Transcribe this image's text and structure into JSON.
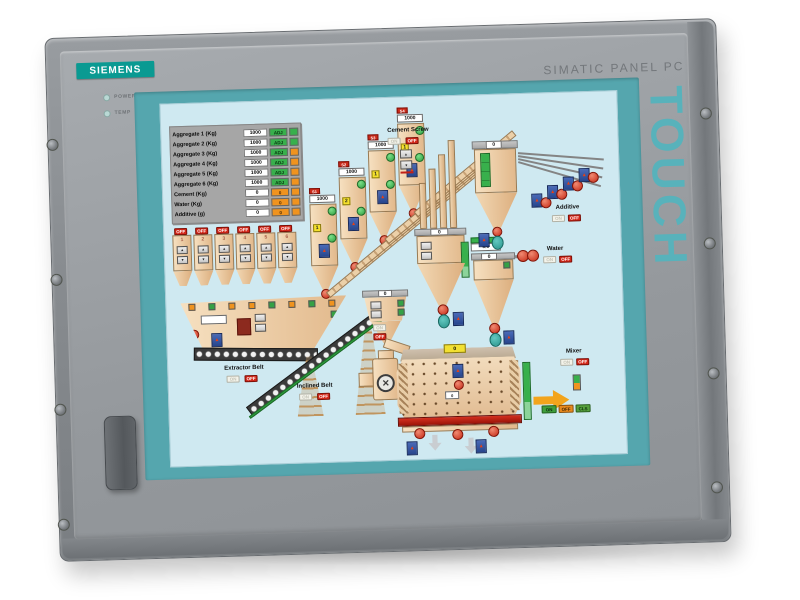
{
  "device": {
    "brand": "SIEMENS",
    "model_label": "SIMATIC PANEL PC",
    "touch_label": "TOUCH",
    "led_power": "POWER",
    "led_temp": "TEMP"
  },
  "hmi": {
    "table": {
      "rows": [
        {
          "label": "Aggregate 1 (Kg)",
          "value": "1000",
          "badge": "ADJ"
        },
        {
          "label": "Aggregate 2 (Kg)",
          "value": "1000",
          "badge": "ADJ"
        },
        {
          "label": "Aggregate 3 (Kg)",
          "value": "1000",
          "badge": "ADJ"
        },
        {
          "label": "Aggregate 4 (Kg)",
          "value": "1000",
          "badge": "ADJ"
        },
        {
          "label": "Aggregate 5 (Kg)",
          "value": "1000",
          "badge": "ADJ"
        },
        {
          "label": "Aggregate 6 (Kg)",
          "value": "1000",
          "badge": "ADJ"
        },
        {
          "label": "Cement (Kg)",
          "value": "0",
          "badge": "0"
        },
        {
          "label": "Water (Kg)",
          "value": "0",
          "badge": "0"
        },
        {
          "label": "Additive (g)",
          "value": "0",
          "badge": "0"
        }
      ]
    },
    "bins": [
      {
        "num": "1"
      },
      {
        "num": "2"
      },
      {
        "num": "3"
      },
      {
        "num": "4"
      },
      {
        "num": "5"
      },
      {
        "num": "6"
      }
    ],
    "silos": [
      {
        "id": "S1",
        "value": "1000",
        "seq": "1"
      },
      {
        "id": "S2",
        "value": "1000",
        "seq": "2"
      },
      {
        "id": "S3",
        "value": "1000",
        "seq": "1"
      },
      {
        "id": "S4",
        "value": "1000",
        "seq": "1"
      }
    ],
    "labels": {
      "cement_screw": "Cement Screw",
      "extractor_belt": "Extractor Belt",
      "inclined_belt": "Inclined Belt",
      "additive": "Additive",
      "water": "Water",
      "mixer": "Mixer",
      "hold_in_mixer": "Hold in Mixer"
    },
    "buttons": {
      "on": "ON",
      "off": "OFF",
      "cls": "CLS",
      "up": "▲",
      "down": "▼"
    },
    "values": {
      "aggregate_weigher": "0",
      "cement_weigher": "0",
      "additive_weigher": "0",
      "water_setpoint": "5.0",
      "water_weigher": "0",
      "mixer_hold": "0",
      "mixer_drum": "0"
    },
    "icons": {
      "motor_glyph": "▲",
      "fan_glyph": "✕"
    },
    "colors": {
      "brand_teal": "#0a9a92",
      "screen_teal": "#55a6ae",
      "lcd_bg": "#cfe9f1",
      "alarm_red": "#d4281a",
      "ok_green": "#38b04c",
      "warn_orange": "#f0931e"
    }
  }
}
